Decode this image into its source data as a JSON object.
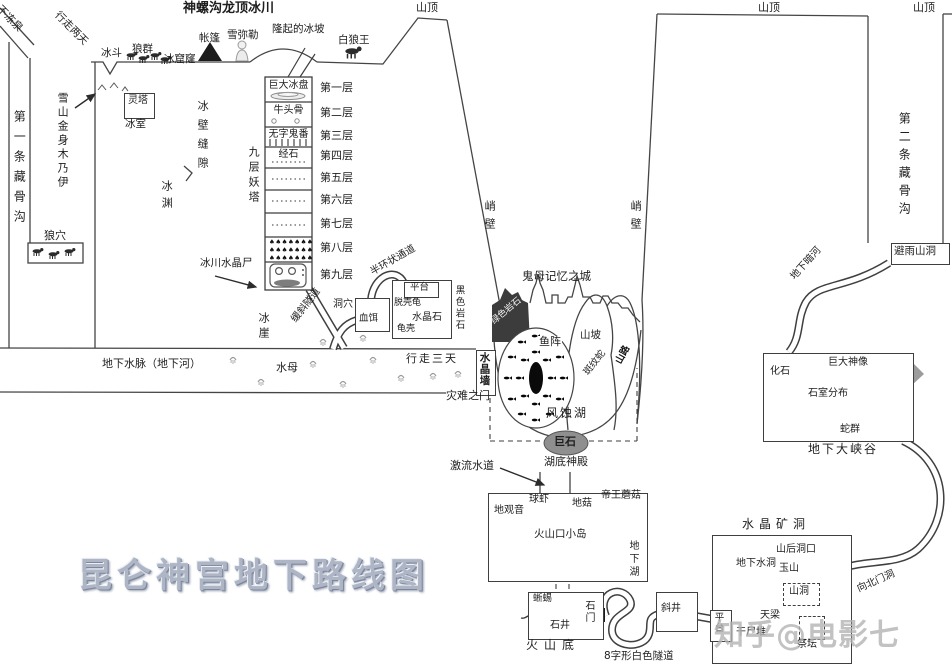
{
  "labels": {
    "map_title": "昆仑神宫地下路线图",
    "glacier_title": "神螺沟龙顶冰川",
    "budongquan": "不冻泉",
    "xingzou_liangtian": "行走两天",
    "diyitiao_canggugou": "第一条藏骨沟",
    "langxue": "狼穴",
    "bingdou": "冰斗",
    "langqun": "狼群",
    "bingkulong": "冰窟窿",
    "zhangpeng": "帐篷",
    "xuemile": "雪弥勒",
    "longqi_bingpo": "隆起的冰坡",
    "bailangwang": "白狼王",
    "shanding": "山顶",
    "xueshan_mummy": "雪山金身木乃伊",
    "lingta": "灵塔",
    "bingshi": "冰室",
    "bingbi_fengxi": "冰壁缝隙",
    "bingyuan": "冰渊",
    "jiuceng_yaota": "九层妖塔",
    "bingchuan_shuijingshi": "冰川水晶尸",
    "huanxie_suidao": "缓斜隧道",
    "bingya": "冰崖",
    "banhuan_tongdao": "半环状通道",
    "dongxue": "洞穴",
    "xueer": "血饵",
    "pingtai": "平台",
    "tuoqiaogui": "脱壳龟",
    "shuijingshi": "水晶石",
    "guike": "龟壳",
    "heise_yanshi": "黑色岩石",
    "xingzou_santian": "行走三天",
    "dixia_shuimai": "地下水脉（地下河）",
    "shuimu": "水母",
    "zainan_zhimen": "灾难之门",
    "shuijingqiang": "水晶墙",
    "qiaobi": "峭壁",
    "guimu_city": "鬼母记忆之城",
    "lvse_yanshi": "绿色岩石",
    "yuzhen": "鱼阵",
    "shanpo": "山坡",
    "banwenshe": "斑纹蛇",
    "shanlu": "山路",
    "fengshihu": "风蚀湖",
    "jushi": "巨石",
    "hudi_shendian": "湖底神殿",
    "jiliu_shuidao": "激流水道",
    "diguanyin": "地观音",
    "qiuxia": "球虾",
    "digu": "地菇",
    "diwang_mogu": "帝王蘑菇",
    "huoshankou_xiaodao": "火山口小岛",
    "dixiahu": "地下湖",
    "xiyi": "蜥蜴",
    "shimen": "石门",
    "shijing": "石井",
    "huoshandi": "火山底",
    "bazixing_suidao": "8字形白色隧道",
    "xiejing": "斜井",
    "shuijing_kuangdong": "水晶矿洞",
    "dixia_shuidong": "地下水洞",
    "shanhou_dongkou": "山后洞口",
    "yushan": "玉山",
    "shandong": "山洞",
    "tianliang": "天梁",
    "ganshidui": "干尸堆",
    "jitan": "祭坛",
    "xiangbei_mendong": "向北门洞",
    "biyu_shandong": "避雨山洞",
    "dixia_anhe": "地下暗河",
    "diertiao_canggugou": "第二条藏骨沟",
    "dixia_daxiagu": "地下大峡谷",
    "huashi": "化石",
    "juda_shenxiang": "巨大神像",
    "shishi_fenbu": "石室分布",
    "shequn": "蛇群",
    "watermark": "知乎@电影七"
  },
  "tower": {
    "floors": [
      {
        "content": "巨大冰盘",
        "label": "第一层"
      },
      {
        "content": "牛头骨",
        "label": "第二层"
      },
      {
        "content": "无字鬼番",
        "label": "第三层"
      },
      {
        "content": "经石",
        "label": "第四层"
      },
      {
        "content": "",
        "label": "第五层"
      },
      {
        "content": "",
        "label": "第六层"
      },
      {
        "content": "",
        "label": "第七层"
      },
      {
        "content": "",
        "label": "第八层"
      },
      {
        "content": "",
        "label": "第九层"
      }
    ]
  },
  "icons": {
    "tree_row": "♠♠♠♠♠♠♠"
  },
  "colors": {
    "line": "#3f3f3f",
    "gray_fill": "#9c9c9c",
    "title": "#aeb6c6",
    "watermark": "#b4b4b4"
  }
}
